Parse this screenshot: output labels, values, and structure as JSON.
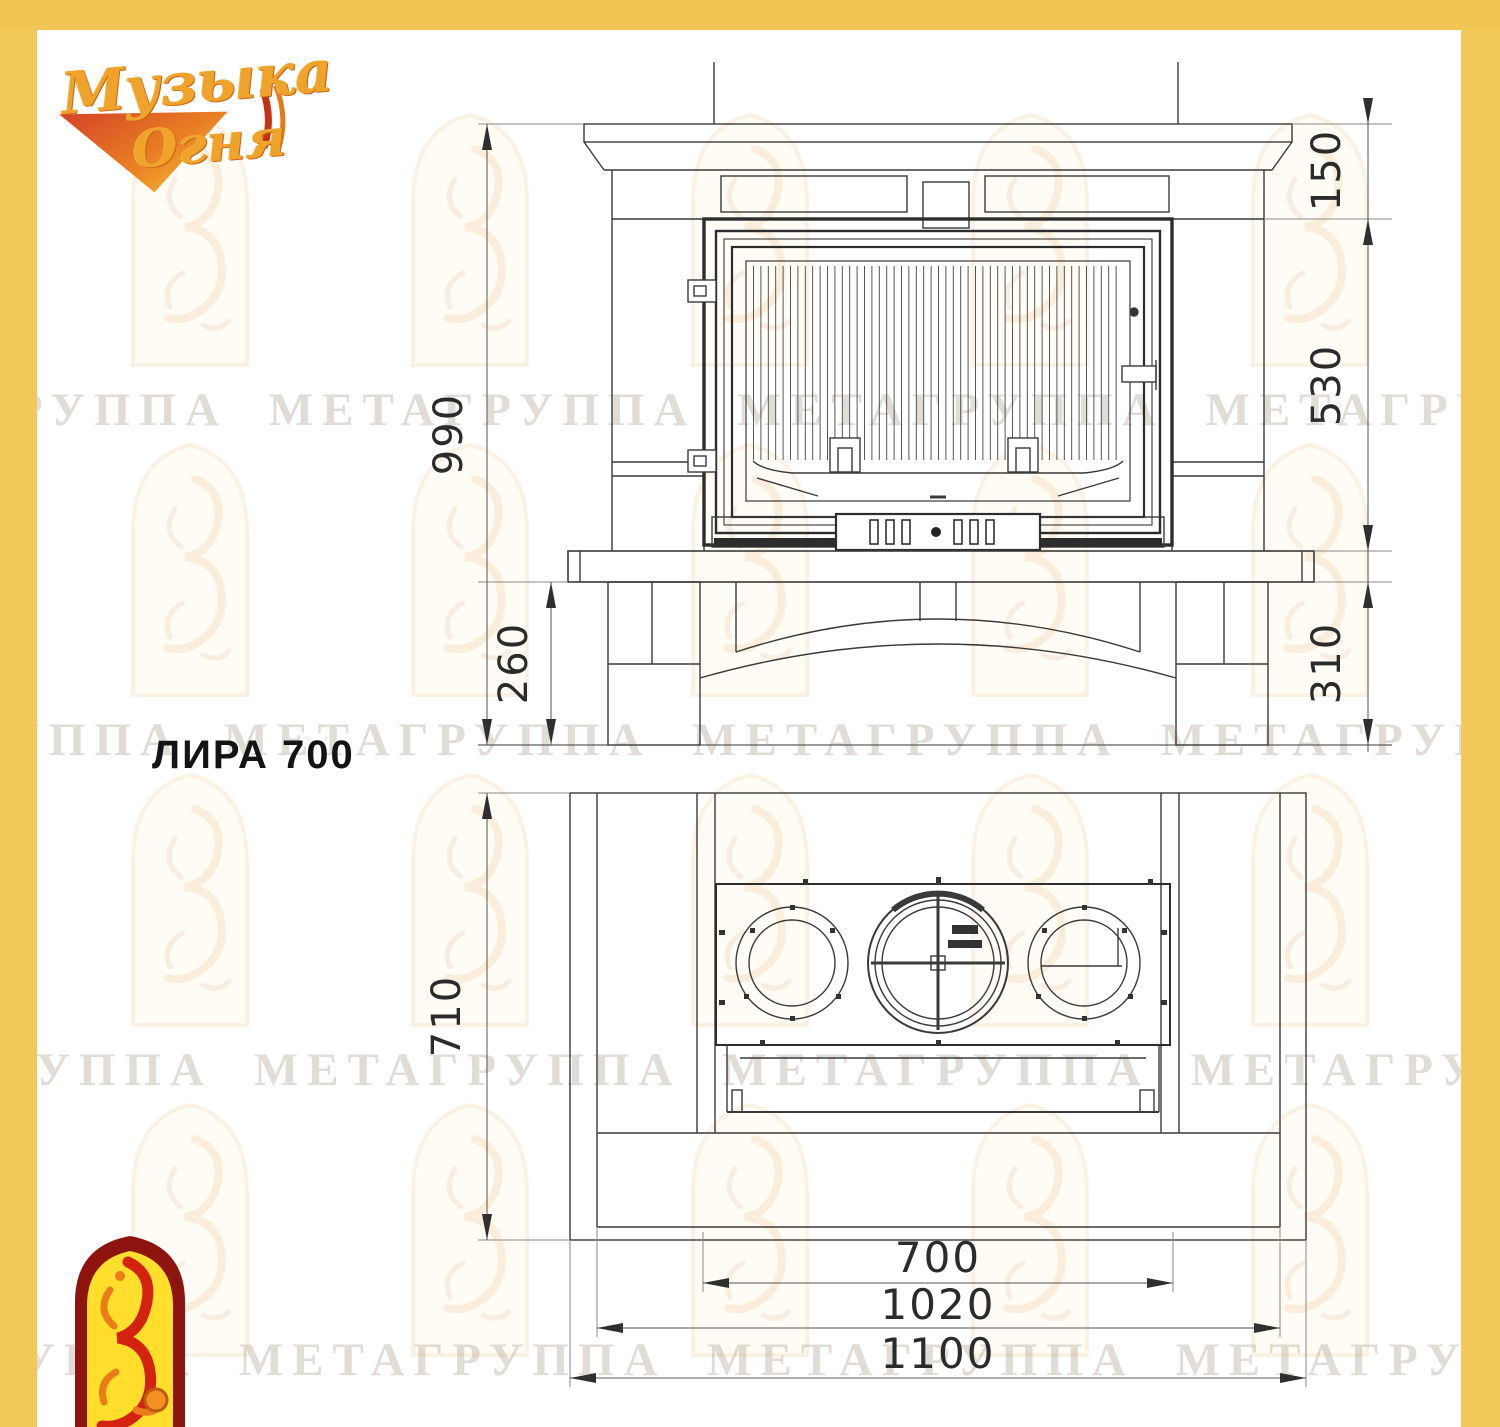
{
  "brand": {
    "line1": "Музыка",
    "line2": "Огня"
  },
  "product": {
    "title": "ЛИРА 700"
  },
  "watermark": {
    "phrase": "ГРУППА МЕТАГРУППА МЕТАГРУППА МЕТАГРУППА МЕТА ГРУППА МЕТАГРУППА МЕТА"
  },
  "colors": {
    "frame_yellow": "#F3C85A",
    "logo_arch_red": "#8E150F",
    "logo_arch_yellow": "#FFDF2B"
  },
  "front_view": {
    "dims": {
      "total_height": "990",
      "mantel_height": "150",
      "firebox_height": "530",
      "base_height": "310",
      "pedestal_height": "260"
    }
  },
  "top_view": {
    "dims": {
      "depth": "710",
      "firebox_width": "700",
      "inner_width": "1020",
      "total_width": "1100"
    }
  }
}
